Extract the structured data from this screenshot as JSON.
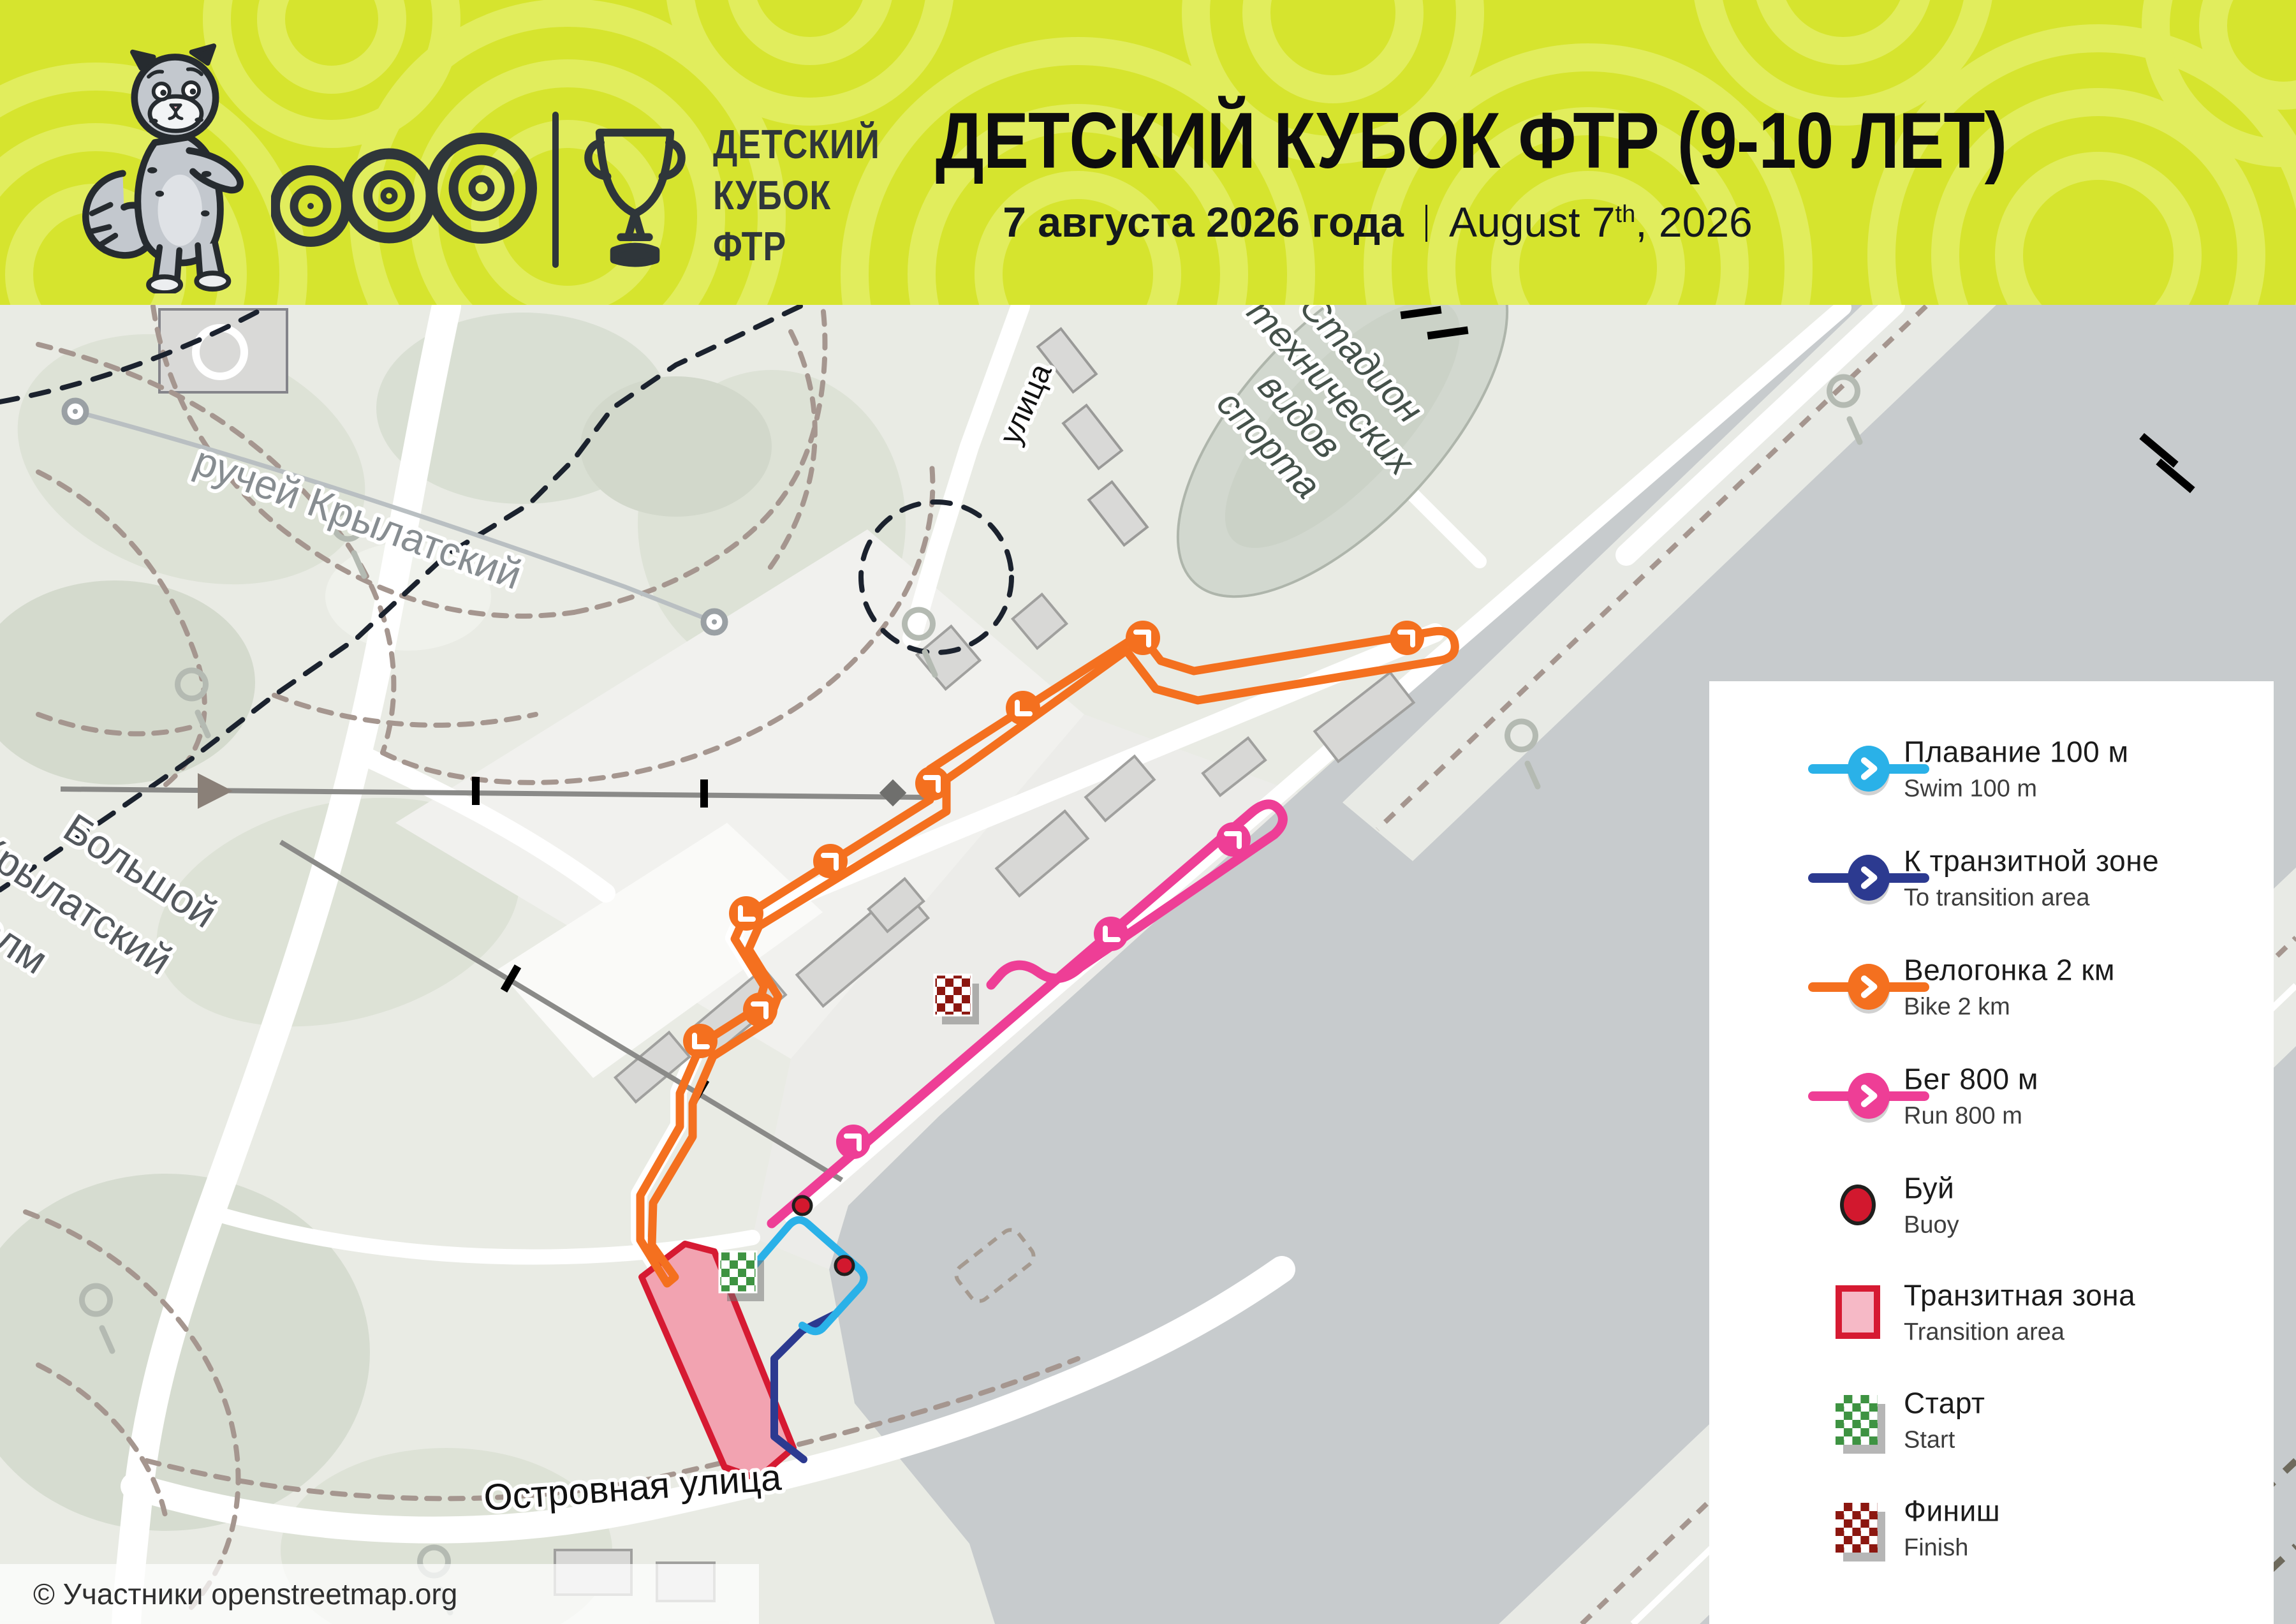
{
  "header": {
    "background_color": "#d6e42e",
    "pattern_color": "#e1ed5d",
    "ink_color": "#2f363a",
    "org_line1": "ДЕТСКИЙ",
    "org_line2": "КУБОК",
    "org_line3": "ФТР",
    "title": "ДЕТСКИЙ КУБОК ФТР (9-10 ЛЕТ)",
    "date_ru": "7 августа 2026 года",
    "date_en_prefix": "August 7",
    "date_en_sup": "th",
    "date_en_suffix": ", 2026"
  },
  "map": {
    "labels": {
      "stream": "ручей Крылатский",
      "hill_line1": "Большой",
      "hill_line2": "Крылатский",
      "hill_line3": "холм",
      "stadium_line1": "Стадион",
      "stadium_line2": "технических",
      "stadium_line3": "видов",
      "stadium_line4": "спорта",
      "street_bottom": "Островная улица",
      "street_top": "улица"
    },
    "attribution": "© Участники openstreetmap.org",
    "colors": {
      "water": "#c7cbcd",
      "park": "#e9ebe4",
      "trail": "#a5968f",
      "boundary": "#1b222e",
      "road": "#ffffff"
    }
  },
  "legend": {
    "items": [
      {
        "label_ru": "Плавание 100 м",
        "label_en": "Swim 100 m",
        "color": "#2ab1e8",
        "icon": "route-line"
      },
      {
        "label_ru": "К транзитной зоне",
        "label_en": "To transition area",
        "color": "#2c3a90",
        "icon": "route-line"
      },
      {
        "label_ru": "Велогонка 2 км",
        "label_en": "Bike 2 km",
        "color": "#f4701f",
        "icon": "route-line"
      },
      {
        "label_ru": "Бег 800 м",
        "label_en": "Run 800 m",
        "color": "#ee3e96",
        "icon": "route-line"
      },
      {
        "label_ru": "Буй",
        "label_en": "Buoy",
        "color": "#d2182e",
        "icon": "buoy"
      },
      {
        "label_ru": "Транзитная зона",
        "label_en": "Transition area",
        "color": "#d61a32",
        "icon": "area"
      },
      {
        "label_ru": "Старт",
        "label_en": "Start",
        "color": "#3e9342",
        "icon": "checker"
      },
      {
        "label_ru": "Финиш",
        "label_en": "Finish",
        "color": "#8c1710",
        "icon": "checker"
      }
    ]
  }
}
